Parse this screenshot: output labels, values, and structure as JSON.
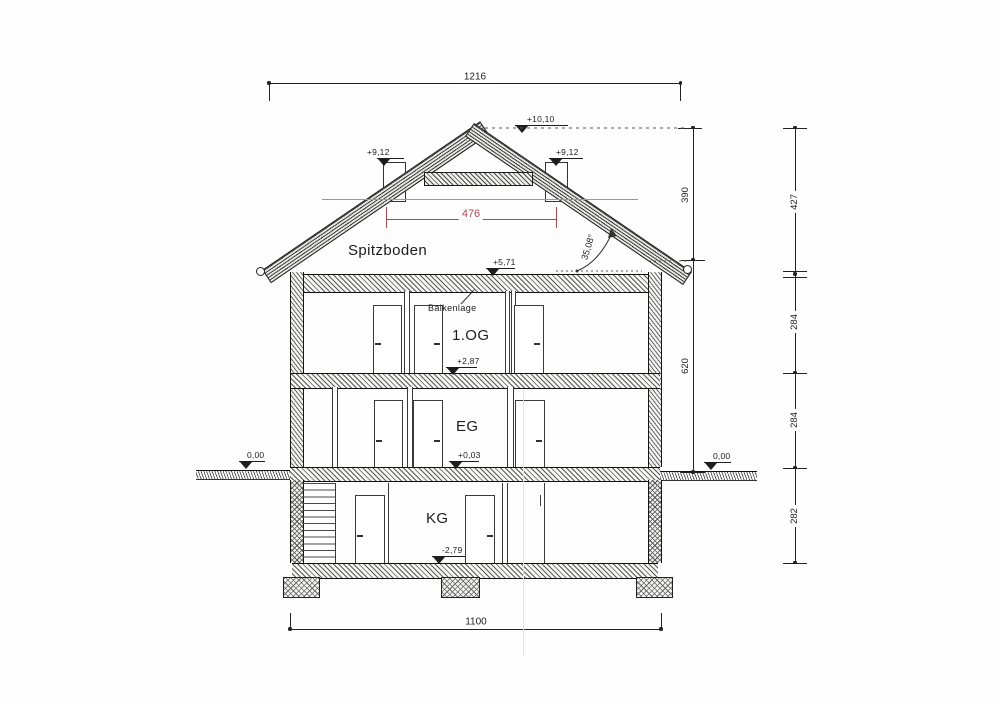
{
  "drawing": {
    "rooms": {
      "attic": "Spitzboden",
      "first_floor": "1.OG",
      "ground_floor": "EG",
      "basement": "KG"
    },
    "annotations": {
      "joists": "Balkenlage",
      "roof_angle": "35,08°"
    },
    "levels": {
      "ridge": "+10,10",
      "chimney_left": "+9,12",
      "chimney_right": "+9,12",
      "attic_floor": "+5,71",
      "first_floor": "+2,87",
      "ground_floor": "+0,03",
      "basement_floor": "-2,79",
      "grade_left": "0,00",
      "grade_right": "0,00"
    },
    "dimensions": {
      "overall_top": "1216",
      "overall_bottom": "1100",
      "attic_width": "476",
      "chain_inner": [
        "390",
        "620"
      ],
      "chain_outer": [
        "427",
        "284",
        "284",
        "282"
      ]
    },
    "colors": {
      "dim_red": "#a84a52",
      "ink": "#222222"
    }
  }
}
